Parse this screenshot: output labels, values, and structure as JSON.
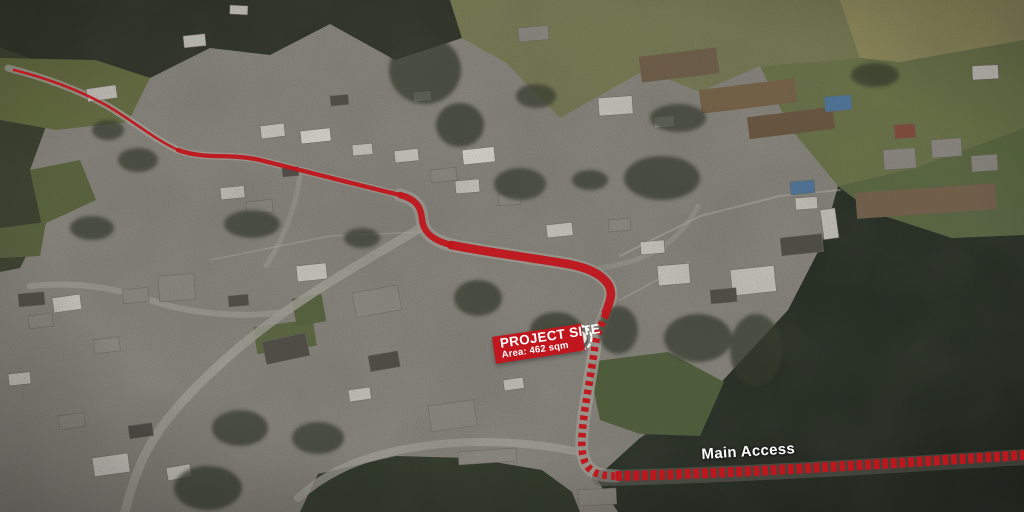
{
  "annotations": {
    "project_site": {
      "title": "PROJECT SITE",
      "area_label": "Area: 462 sqm",
      "marker_icon": "circle-marker-with-dashed-ring"
    },
    "main_access": {
      "label": "Main Access"
    }
  },
  "colors": {
    "route_red": "#bf161c",
    "banner_red": "#c0161d",
    "marker_white": "#ffffff",
    "label_text": "#ffffff"
  }
}
